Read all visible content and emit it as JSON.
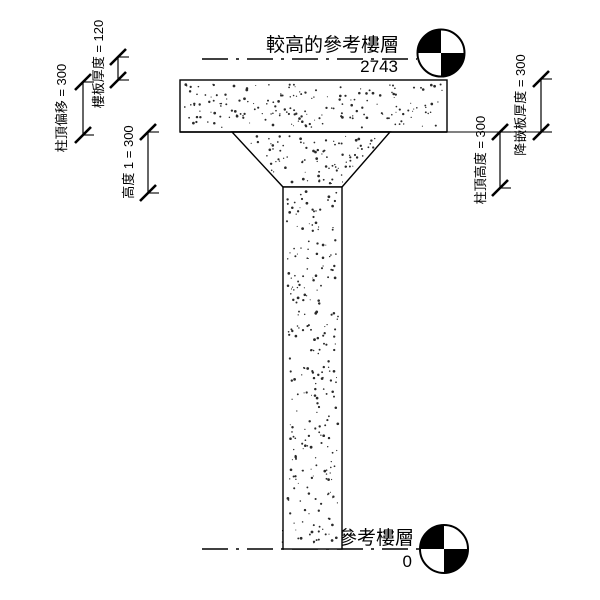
{
  "diagram": {
    "title_hint": "column-with-drop-panel-section",
    "upper_level": {
      "label": "較高的參考樓層",
      "value": "2743"
    },
    "lower_level": {
      "label": "較低的參考樓層",
      "value": "0"
    },
    "dimensions": {
      "column_top_offset": "柱頂偏移 = 300",
      "floor_thickness": "樓板厚度 = 120",
      "height_1": "高度 1 = 300",
      "column_top_height": "柱頂高度 = 300",
      "drop_panel_thickness": "降嵌板厚度 = 300"
    },
    "colors": {
      "line": "#000000",
      "background": "#ffffff",
      "stipple": "#2a2a2a"
    }
  }
}
